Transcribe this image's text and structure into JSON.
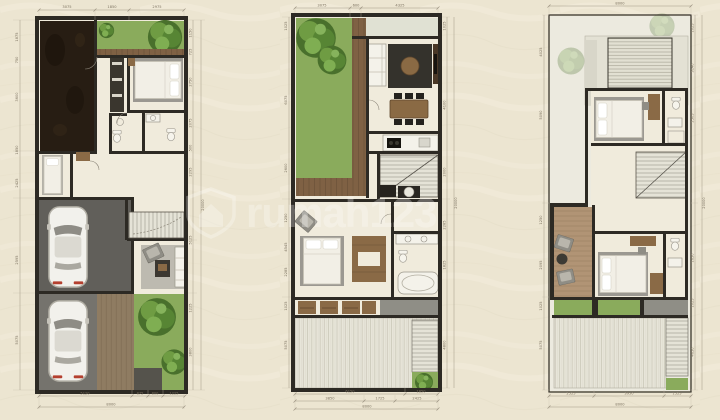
{
  "sheet": {
    "description_label": "three-storey house floor plans",
    "floors": [
      "floor-plan-1",
      "floor-plan-2",
      "floor-plan-3"
    ]
  },
  "watermark": {
    "text": "rumah123",
    "logo": "rumah123-shield-house-logo"
  },
  "palette": {
    "bg": "#ece5d1",
    "floor": "#f0ebdc",
    "floorAlt": "#eceadf",
    "wall": "#2d2a24",
    "soil": "#271d13",
    "garden": "#8aab5c",
    "tree": "#5d8c37",
    "treeDark": "#49702c",
    "wood": "#8a6a46",
    "rug": "#34322c",
    "paving": "#615f5a",
    "pavingLight": "#75736d",
    "roof": "#e3e1d4",
    "grayslab": "#8f8e86",
    "white": "#f4f2ea",
    "dimline": "#9a9180",
    "dimtext": "#7d7361",
    "wmark": "#ffffff"
  },
  "plans": [
    {
      "id": "floor-plan-1",
      "dims": {
        "top": [
          "3075",
          "1850",
          "2975"
        ],
        "bottom": [
          "5120",
          "875",
          "800",
          "1225"
        ],
        "bottom_total": "8000",
        "left": [
          "1875",
          "750",
          "3600",
          "1850",
          "2425",
          "2595",
          "5075"
        ],
        "right": [
          "1150",
          "725",
          "2750",
          "2075",
          "500",
          "2295",
          "5125",
          "1225",
          "3800"
        ],
        "overall": "20000"
      }
    },
    {
      "id": "floor-plan-2",
      "dims": {
        "top": [
          "3075",
          "600",
          "4325"
        ],
        "bottom": [
          "6150",
          "1850"
        ],
        "bottom2": [
          "3850",
          "1725",
          "2425"
        ],
        "bottom_total": "8000",
        "left": [
          "1025",
          "6075",
          "2600",
          "1250",
          "4545",
          "2285",
          "1025",
          "5075"
        ],
        "right": [
          "1025",
          "4100",
          "2000",
          "2285",
          "1825",
          "4800"
        ],
        "overall": "20000"
      }
    },
    {
      "id": "floor-plan-3",
      "dims": {
        "top_total": "8000",
        "bottom": [
          "2525",
          "3950",
          "1525"
        ],
        "bottom_total": "8000",
        "left": [
          "4025",
          "5090",
          "1250",
          "2095",
          "1025",
          "5075"
        ],
        "right": [
          "1025",
          "3140",
          "2505",
          "1650",
          "1025",
          "4650"
        ],
        "overall": "20000"
      }
    }
  ]
}
